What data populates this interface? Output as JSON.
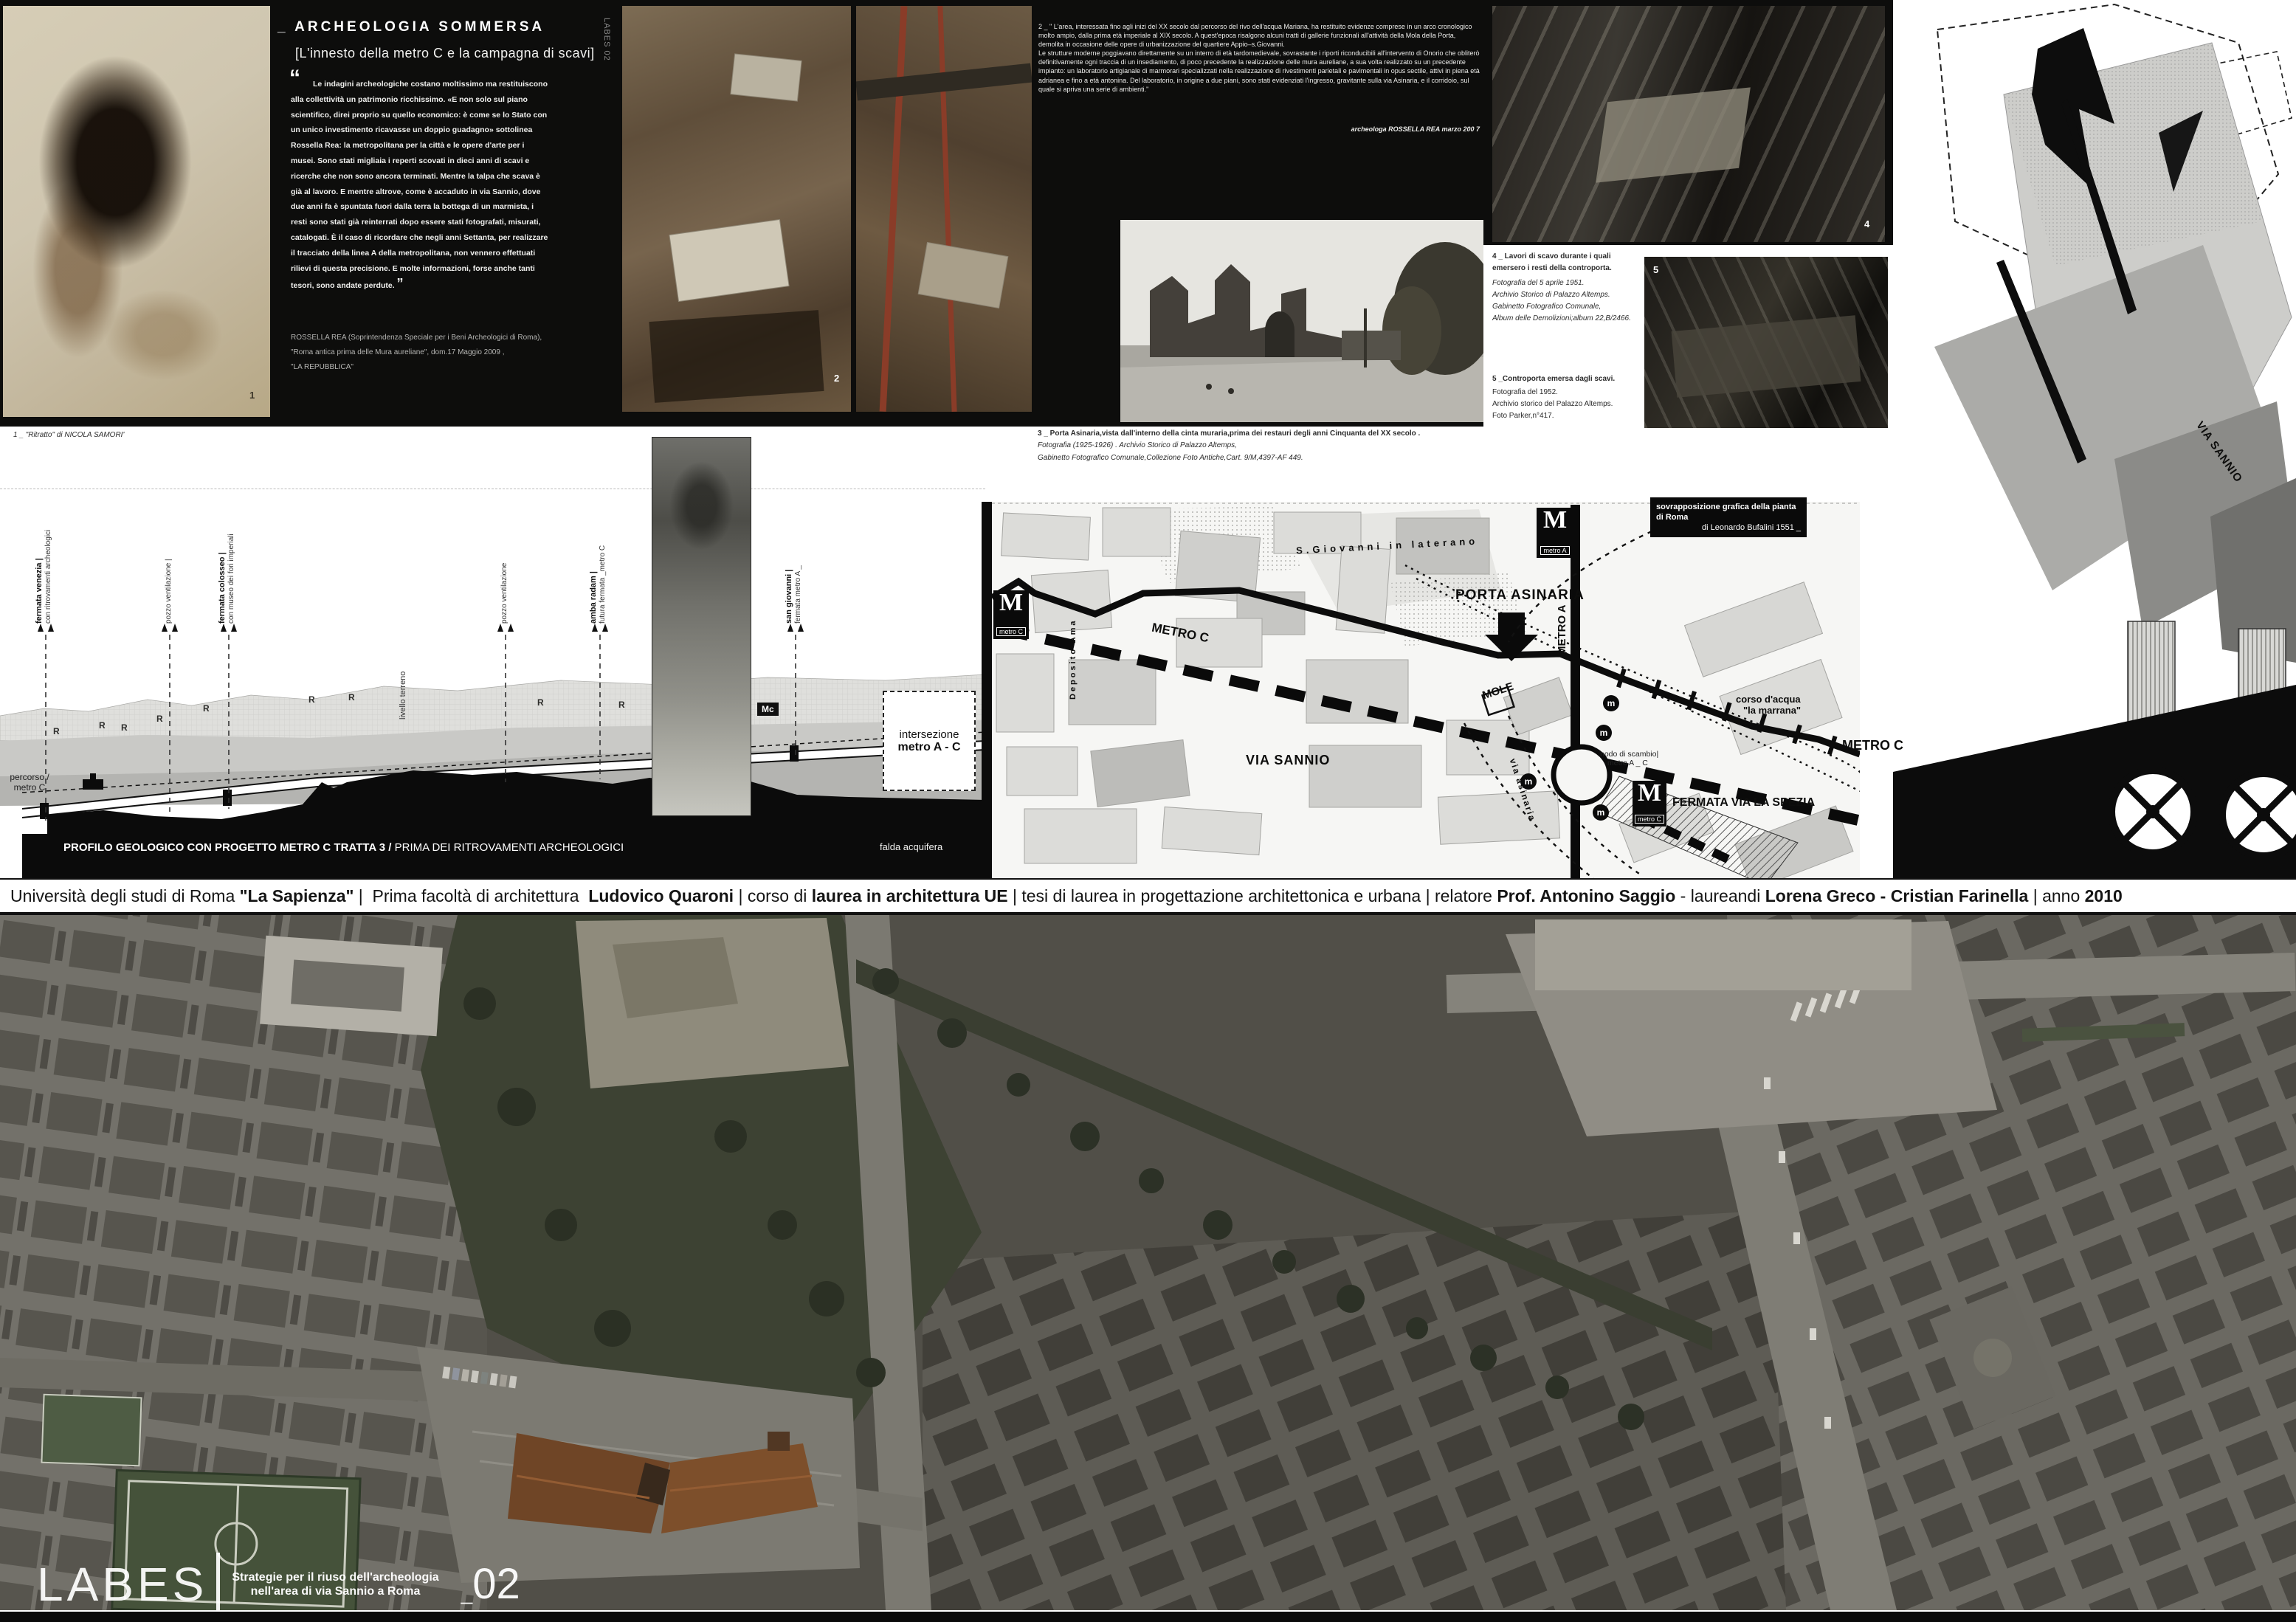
{
  "colors": {
    "board_black": "#0d0d0c",
    "paper": "#ffffff",
    "intervention_brown": "#6f4526"
  },
  "header": {
    "side_label": "LABES 02",
    "title": "_ ARCHEOLOGIA SOMMERSA",
    "subtitle": "[L'innesto della metro C e la campagna di scavi]",
    "quote_open": "“",
    "quote": "Le indagini archeologiche costano moltissimo ma restituiscono alla collettività un patrimonio ricchissimo. «E non solo sul piano scientifico, direi proprio su quello economico: è come se lo Stato con un unico investimento ricavasse un doppio guadagno» sottolinea Rossella Rea: la metropolitana per la città e le opere d'arte per i musei. Sono stati migliaia i reperti scovati in dieci anni di scavi e ricerche che non sono ancora terminati. Mentre la talpa che scava è già al lavoro. E mentre altrove, come è accaduto in via Sannio, dove due anni fa è spuntata fuori dalla terra la bottega di un marmista, i resti sono stati già reinterrati dopo essere stati fotografati, misurati, catalogati. È il caso di ricordare che negli anni Settanta, per realizzare il tracciato della linea A della metropolitana, non vennero effettuati rilievi di questa precisione. E molte informazioni, forse anche tanti tesori, sono andate perdute.",
    "quote_close": "”",
    "attribution": "ROSSELLA REA (Soprintendenza Speciale per i Beni Archeologici di Roma),\n\"Roma antica prima delle Mura aureliane\", dom.17 Maggio 2009 ,\n\"LA REPUBBLICA\"",
    "caption1": "1 _ \"Ritratto\" di NICOLA SAMORI'",
    "photo1_num": "1",
    "photo2_num": "2",
    "para2": "2 _ \" L'area, interessata fino agli inizi del XX secolo dal percorso del rivo dell'acqua Mariana, ha restituito evidenze comprese in un arco cronologico molto ampio, dalla prima età imperiale al XIX secolo. A quest'epoca risalgono alcuni tratti di gallerie funzionali all'attività della Mola della Porta, demolita in occasione delle opere di urbanizzazione del quartiere Appio–s.Giovanni.\nLe strutture moderne poggiavano direttamente su un interro di età tardomedievale, sovrastante i riporti riconducibili all'intervento di Onorio che obliterò definitivamente ogni traccia di un insediamento, di poco precedente la realizzazione delle mura aureliane, a sua volta realizzato su un precedente impianto: un laboratorio artigianale di marmorari specializzati nella realizzazione di rivestimenti parietali e pavimentali in opus sectile, attivi in piena età adrianea e fino a età antonina. Del laboratorio, in origine a due piani, sono stati evidenziati l'ingresso, gravitante sulla via Asinaria, e il corridoio, sul quale si apriva una serie di ambienti.\"",
    "para2_attr": "archeologa  ROSSELLA REA marzo 200 7",
    "caption3_bold": "3 _ Porta Asinaria,vista dall'interno della cinta muraria,prima dei restauri degli anni Cinquanta del XX secolo .",
    "caption3_italic": "Fotografia (1925-1926) . Archivio Storico di Palazzo Altemps,\nGabinetto Fotografico Comunale,Collezione Foto Antiche,Cart. 9/M,4397-AF 449.",
    "photo4_num": "4",
    "caption4_bold": "4 _ Lavori di scavo durante i quali\nemersero i resti della  controporta.",
    "caption4_italic": "Fotografia del 5 aprile 1951.\nArchivio Storico di Palazzo Altemps.\nGabinetto Fotografico Comunale,\nAlbum delle Demolizioni;album 22,B/2466.",
    "photo5_num": "5",
    "caption5_bold": "5 _Controporta emersa dagli scavi.",
    "caption5_rest": "Fotografia del 1952.\nArchivio storico del Palazzo Altemps.\nFoto Parker,n°417."
  },
  "profile": {
    "labels": [
      {
        "bold": "fermata venezia |",
        "light": "con ritrovamenti archeologici"
      },
      {
        "bold": "pozzo ventilazione |",
        "light": ""
      },
      {
        "bold": "fermata colosseo |",
        "light": "con museo dei fori imperiali"
      },
      {
        "bold": "pozzo ventilazione",
        "light": ""
      },
      {
        "bold": "amba radam |",
        "light": "futura fermata _metro C"
      },
      {
        "bold": "san giovanni |",
        "light": "fermata metro A _"
      }
    ],
    "livello": "livello terreno",
    "percorso": "percorso /\nmetro C",
    "title_bold": "PROFILO GEOLOGICO CON PROGETTO METRO C TRATTA 3 /",
    "title_rest": " PRIMA DEI RITROVAMENTI ARCHEOLOGICI",
    "falda": "falda acquifera",
    "intersezione_l1": "intersezione",
    "intersezione_l2": "metro A - C",
    "mc": "Mc",
    "r": "R"
  },
  "map": {
    "badge_m": "M",
    "badge_metroC": "metro C",
    "badge_metroA": "metro A",
    "metro_c_line": "METRO C",
    "metro_a_line": "METRO A",
    "metro_c_right": "METRO C",
    "sgiovanni": "S.Giovanni in laterano",
    "porta_asinaria": "PORTA ASINARIA",
    "mole": "MOLE",
    "corso1": "corso d'acqua",
    "corso2": "\"la marrana\"",
    "via_sannio": "VIA SANNIO",
    "deposito": "Deposito\nAma",
    "nodo1": "nodo di scambio|",
    "nodo2": "metro A _ C",
    "fermata": "FERMATA\nVIA LA SPEZIA",
    "via_asinaria": "via asinaria",
    "m_small": "m",
    "overlay1": "sovrapposizione  grafica della pianta di Roma",
    "overlay2": "di Leonardo Bufalini 1551 _",
    "via_sannio_right": "VIA SANNIO"
  },
  "credits": {
    "s1": "Università degli studi di Roma ",
    "s2": "\"La Sapienza\"",
    "s3": " |  ",
    "s4": "Prima facoltà di architettura  ",
    "s5": "Ludovico Quaroni",
    "s6": " | corso di ",
    "s7": "laurea in architettura UE",
    "s8": " | tesi di laurea in progettazione architettonica e urbana | relatore ",
    "s9": "Prof. Antonino Saggio",
    "s10": " - laureandi ",
    "s11": "Lorena Greco - Cristian Farinella",
    "s12": " | anno ",
    "s13": "2010"
  },
  "footer": {
    "labes": "LABES",
    "line1": "Strategie per il riuso dell'archeologia",
    "line2": "nell'area di via Sannio a Roma",
    "underscore": "_",
    "number": "02"
  }
}
